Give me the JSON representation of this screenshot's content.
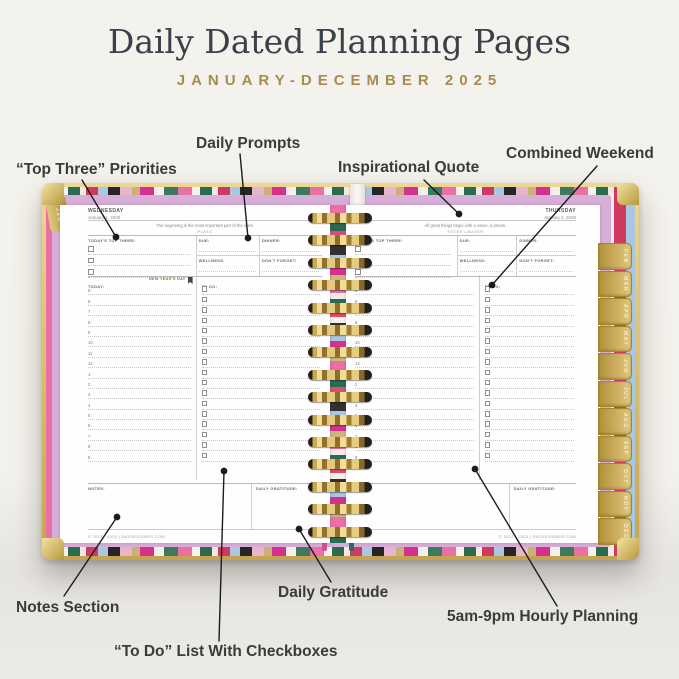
{
  "colors": {
    "background": "#f4f2ec",
    "title": "#3a414b",
    "accent_gold": "#a78b50",
    "label": "#3b3b3b",
    "lavender": "#d7aed7",
    "cover_gold": "#c6a44e"
  },
  "header": {
    "title": "Daily Dated Planning Pages",
    "subtitle": "JANUARY-DECEMBER 2025"
  },
  "callouts": {
    "top_three": "“Top Three” Priorities",
    "daily_prompts": "Daily Prompts",
    "inspirational_quote": "Inspirational Quote",
    "combined_weekend": "Combined Weekend",
    "notes_section": "Notes Section",
    "todo_list": "“To Do” List With Checkboxes",
    "daily_gratitude": "Daily Gratitude",
    "hourly_planning": "5am-9pm Hourly Planning"
  },
  "planner": {
    "tabs": {
      "jan": "JAN",
      "months": [
        "FEB",
        "MAR",
        "APR",
        "MAY",
        "JUN",
        "JUL",
        "AUG",
        "SEP",
        "OCT",
        "NOV",
        "DEC"
      ]
    },
    "pages": [
      {
        "day": "WEDNESDAY",
        "date": "January 1, 2025",
        "quote": "The beginning is the most important part of the work.",
        "quote_author": "PLATO",
        "top_three_label": "TODAY'S TOP THREE:",
        "due_label": "DUE:",
        "dinner_label": "DINNER:",
        "wellness_label": "WELLNESS:",
        "dont_forget_label": "DON'T FORGET:",
        "today_label": "TODAY:",
        "holiday": "NEW YEAR'S DAY",
        "todo_label": "TO DO:",
        "hours": [
          "5",
          "6",
          "7",
          "8",
          "9",
          "10",
          "11",
          "12",
          "1",
          "2",
          "3",
          "4",
          "5",
          "6",
          "7",
          "8",
          "9"
        ],
        "notes_label": "NOTES:",
        "gratitude_label": "DAILY GRATITUDE:",
        "footer": "© 2012 - 2023 | DAYDESIGNER.COM"
      },
      {
        "day": "THURSDAY",
        "date": "January 2, 2025",
        "quote": "All great things begin with a vision, a dream.",
        "quote_author": "ESTEE LAUDER",
        "top_three_label": "TODAY'S TOP THREE:",
        "due_label": "DUE:",
        "dinner_label": "DINNER:",
        "wellness_label": "WELLNESS:",
        "dont_forget_label": "DON'T FORGET:",
        "today_label": "TODAY:",
        "holiday": "",
        "todo_label": "TO DO:",
        "hours": [
          "5",
          "6",
          "7",
          "8",
          "9",
          "10",
          "11",
          "12",
          "1",
          "2",
          "3",
          "4",
          "5",
          "6",
          "7",
          "8",
          "9"
        ],
        "notes_label": "NOTES:",
        "gratitude_label": "DAILY GRATITUDE:",
        "footer": "© 2012 - 2023 | DAYDESIGNER.COM"
      }
    ]
  }
}
